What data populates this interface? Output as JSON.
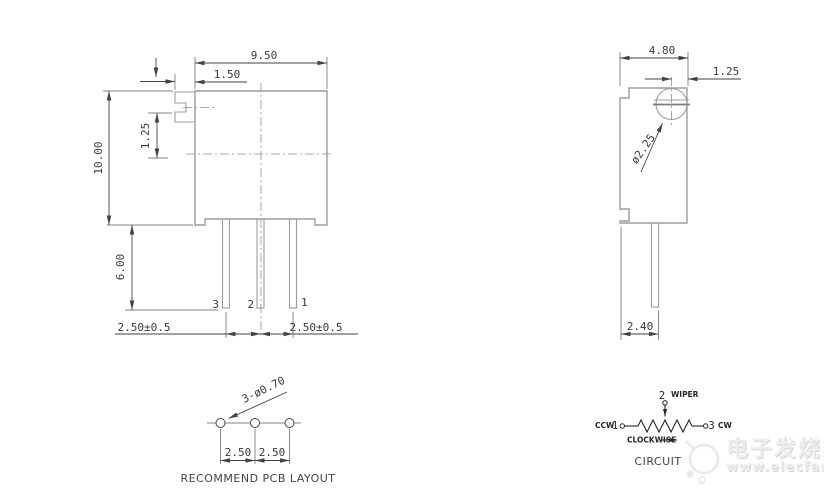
{
  "drawing": {
    "front_view": {
      "width": "9.50",
      "slot_offset": "1.50",
      "slot_center_offset": "1.25",
      "height": "10.00",
      "pin_length": "6.00",
      "pin_pitch_left": "2.50±0.5",
      "pin_pitch_right": "2.50±0.5",
      "pin_labels": [
        "3",
        "2",
        "1"
      ]
    },
    "side_view": {
      "width": "4.80",
      "screw_edge_offset": "1.25",
      "screw_diameter": "ø2.25",
      "pin_edge_offset": "2.40"
    },
    "pcb_layout": {
      "holes_note": "3-ø0.70",
      "pitch_a": "2.50",
      "pitch_b": "2.50",
      "caption": "RECOMMEND PCB LAYOUT"
    },
    "circuit": {
      "wiper_terminal": "2",
      "wiper_label": "WIPER",
      "ccw_label": "CCW",
      "ccw_terminal": "1",
      "cw_terminal": "3",
      "cw_label": "CW",
      "rotation_label": "CLOCKWISE",
      "caption": "CIRCUIT"
    }
  },
  "watermark": {
    "brand": "电子发烧友",
    "url": "www.elecfans.com"
  },
  "colors": {
    "background": "#ffffff",
    "body_outline": "#9d9d9d",
    "dimension_line": "#424242",
    "centerline": "#8f8f8f",
    "watermark_text": "#ededed"
  }
}
